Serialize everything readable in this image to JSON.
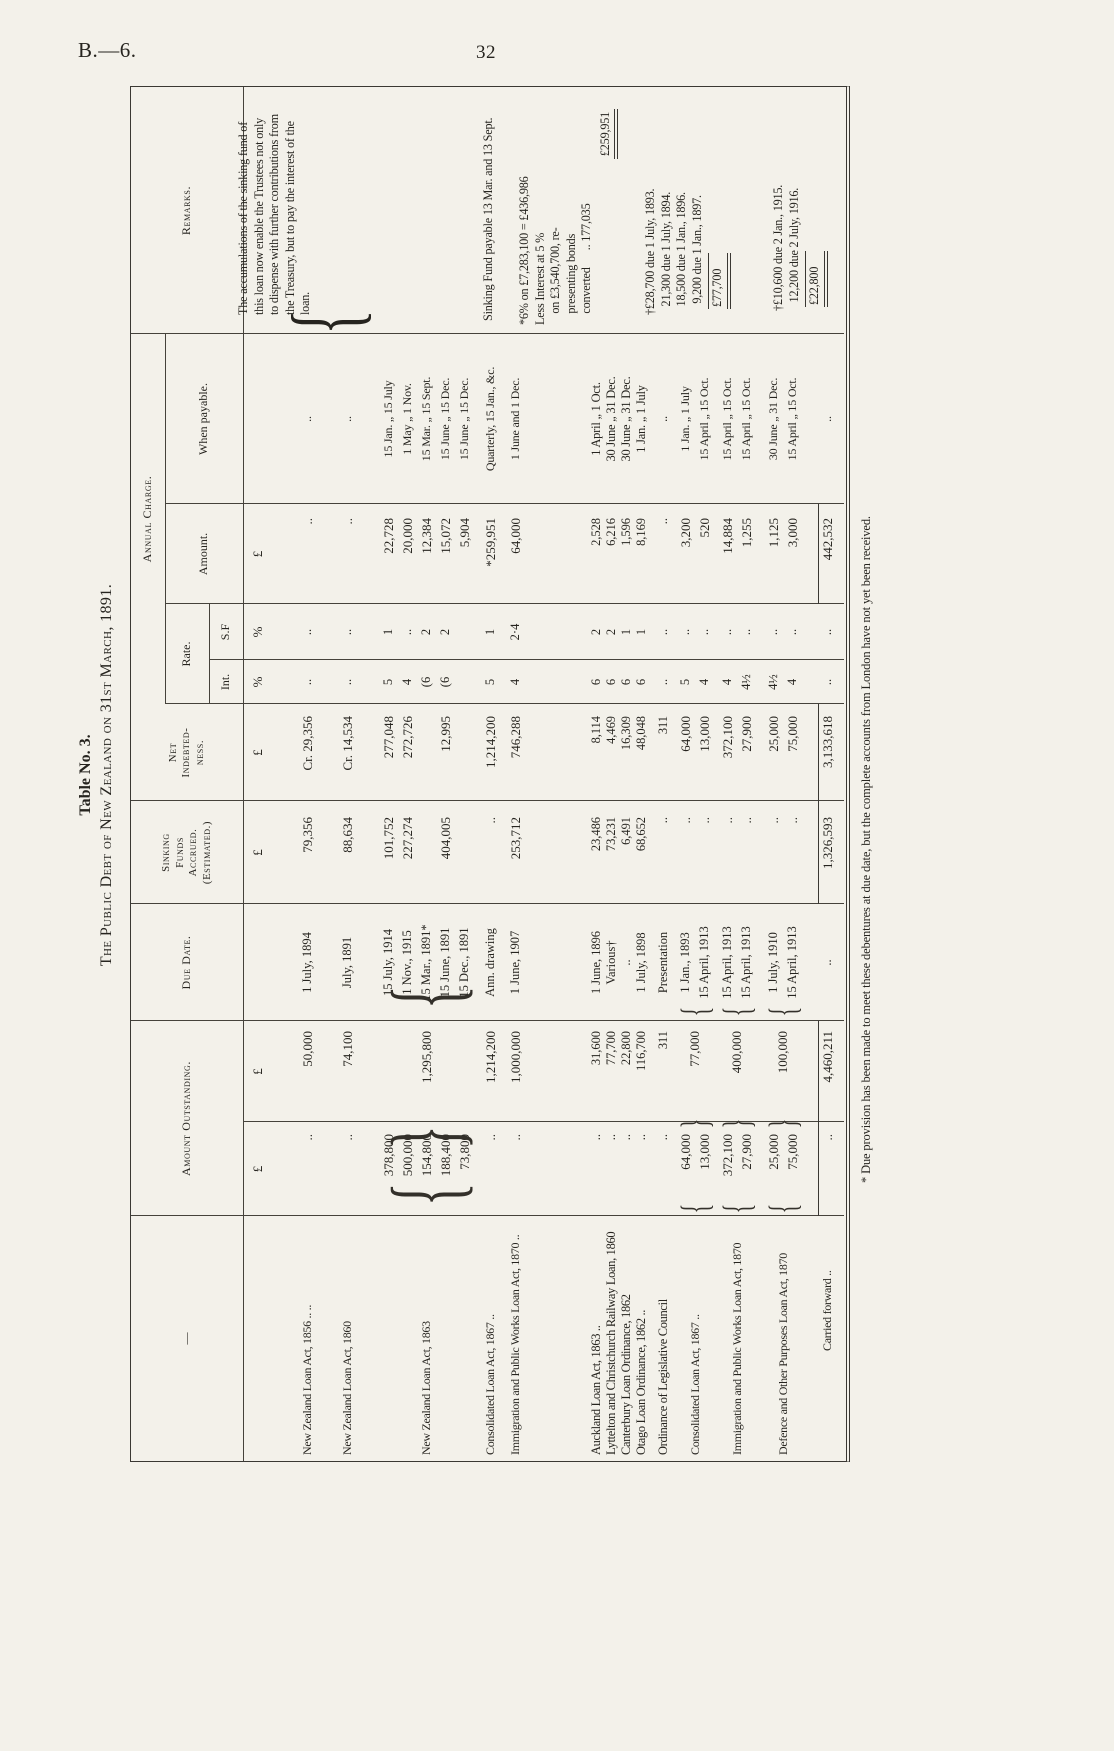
{
  "page": {
    "doc_ref": "B.—6.",
    "page_number": "32"
  },
  "title": {
    "table_no": "Table No. 3.",
    "main": "The Public Debt of New Zealand on 31st March, 1891."
  },
  "headers": {
    "first_col": "—",
    "amount_outstanding": "Amount Outstanding.",
    "due_date": "Due Date.",
    "sinking_funds": [
      "Sinking",
      "Funds",
      "Accrued.",
      "(Estimated.)"
    ],
    "net_indebtedness": [
      "Net",
      "Indebted-",
      "ness."
    ],
    "annual_charge": "Annual Charge.",
    "rate": "Rate.",
    "int": "Int.",
    "sf": "S.F",
    "amount": "Amount.",
    "when_payable": "When payable.",
    "remarks": "Remarks."
  },
  "symbols": {
    "item": "£",
    "total": "£",
    "sinking": "£",
    "net": "£",
    "int": "%",
    "sf": "%",
    "amount": "£"
  },
  "rows": [
    {
      "name": "New Zealand Loan Act, 1856  ..   ..",
      "item": "..",
      "total": "50,000",
      "due": "1 July, 1894",
      "sinking": "79,356",
      "net": "Cr. 29,356",
      "int": "..",
      "sf": "..",
      "amount": "..",
      "payable": ".."
    },
    {
      "name": "New Zealand Loan Act, 1860",
      "item": "..",
      "total": "74,100",
      "due": "July, 1891",
      "sinking": "88,634",
      "net": "Cr. 14,534",
      "int": "..",
      "sf": "..",
      "amount": "..",
      "payable": ".."
    },
    {
      "name": "New Zealand Loan Act, 1863",
      "brace": true,
      "item": [
        "378,800",
        "500,000",
        "154,800",
        "188,400",
        "73,800"
      ],
      "total": "1,295,800",
      "due": [
        "15 July, 1914",
        "1 Nov., 1915",
        "15 Mar., 1891*",
        "15 June, 1891",
        "15 Dec., 1891"
      ],
      "sinking": [
        "101,752",
        "227,274",
        "",
        "404,005",
        ""
      ],
      "net": [
        "277,048",
        "272,726",
        "",
        "12,995",
        ""
      ],
      "int": [
        "5",
        "4",
        "(6",
        "(6",
        ""
      ],
      "sf": [
        "1",
        "..",
        "2",
        "2",
        ""
      ],
      "amount": [
        "22,728",
        "20,000",
        "12,384",
        "15,072",
        "5,904"
      ],
      "payable": [
        "15 Jan. „ 15 July",
        "1 May „ 1 Nov.",
        "15 Mar. „ 15 Sept.",
        "15 June „ 15 Dec.",
        "15 June „ 15 Dec."
      ]
    },
    {
      "name": "Consolidated Loan Act, 1867 ..",
      "item": "..",
      "total": "1,214,200",
      "due": "Ann. drawing",
      "sinking": "..",
      "net": "1,214,200",
      "int": "5",
      "sf": "1",
      "amount": "*259,951",
      "payable": "Quarterly, 15 Jan., &c."
    },
    {
      "name": "Immigration and Public Works Loan Act, 1870 ..",
      "item": "..",
      "total": "1,000,000",
      "due": "1 June, 1907",
      "sinking": "253,712",
      "net": "746,288",
      "int": "4",
      "sf": "2·4",
      "amount": "64,000",
      "payable": "1 June and 1 Dec."
    },
    {
      "name": "Auckland Loan Act, 1863   ..",
      "item": "..",
      "total": "31,600",
      "due": "1 June, 1896",
      "sinking": "23,486",
      "net": "8,114",
      "int": "6",
      "sf": "2",
      "amount": "2,528",
      "payable": "1 April „ 1 Oct."
    },
    {
      "name": "Lyttelton and Christchurch Railway Loan, 1860",
      "item": "..",
      "total": "77,700",
      "due": "Various†",
      "sinking": "73,231",
      "net": "4,469",
      "int": "6",
      "sf": "2",
      "amount": "6,216",
      "payable": "30 June „ 31 Dec."
    },
    {
      "name": "Canterbury Loan Ordinance, 1862",
      "item": "..",
      "total": "22,800",
      "due": "..",
      "sinking": "6,491",
      "net": "16,309",
      "int": "6",
      "sf": "1",
      "amount": "1,596",
      "payable": "30 June „ 31 Dec."
    },
    {
      "name": "Otago Loan Ordinance, 1862  ..",
      "item": "..",
      "total": "116,700",
      "due": "1 July, 1898",
      "sinking": "68,652",
      "net": "48,048",
      "int": "6",
      "sf": "1",
      "amount": "8,169",
      "payable": "1 Jan. „ 1 July"
    },
    {
      "name": "Ordinance of Legislative Council",
      "item": "..",
      "total": "311",
      "due": "Presentation",
      "sinking": "..",
      "net": "311",
      "int": "..",
      "sf": "..",
      "amount": "..",
      "payable": ".."
    },
    {
      "name": "Consolidated Loan Act, 1867 ..",
      "brace": true,
      "item": [
        "64,000",
        "13,000"
      ],
      "total": "77,000",
      "due": [
        "1 Jan., 1893",
        "15 April, 1913"
      ],
      "sinking": [
        "..",
        ".."
      ],
      "net": [
        "64,000",
        "13,000"
      ],
      "int": [
        "5",
        "4"
      ],
      "sf": [
        "..",
        ".."
      ],
      "amount": [
        "3,200",
        "520"
      ],
      "payable": [
        "1 Jan. „ 1 July",
        "15 April „ 15 Oct."
      ]
    },
    {
      "name": "Immigration and Public Works Loan Act, 1870",
      "brace": true,
      "item": [
        "372,100",
        "27,900"
      ],
      "total": "400,000",
      "due": [
        "15 April, 1913",
        "15 April, 1913"
      ],
      "sinking": [
        "..",
        ".."
      ],
      "net": [
        "372,100",
        "27,900"
      ],
      "int": [
        "4",
        "4½"
      ],
      "sf": [
        "..",
        ".."
      ],
      "amount": [
        "14,884",
        "1,255"
      ],
      "payable": [
        "15 April „ 15 Oct.",
        "15 April „ 15 Oct."
      ]
    },
    {
      "name": "Defence and Other Purposes Loan Act, 1870",
      "brace": true,
      "item": [
        "25,000",
        "75,000"
      ],
      "total": "100,000",
      "due": [
        "1 July, 1910",
        "15 April, 1913"
      ],
      "sinking": [
        "..",
        ".."
      ],
      "net": [
        "25,000",
        "75,000"
      ],
      "int": [
        "4½",
        "4"
      ],
      "sf": [
        "..",
        ".."
      ],
      "amount": [
        "1,125",
        "3,000"
      ],
      "payable": [
        "30 June „ 31 Dec.",
        "15 April „ 15 Oct."
      ]
    },
    {
      "name": "Carried forward   ..",
      "item": "..",
      "total": "4,460,211",
      "due": "..",
      "sinking": "1,326,593",
      "net": "3,133,618",
      "int": "..",
      "sf": "..",
      "amount": "442,532",
      "payable": ".."
    }
  ],
  "remarks_blocks": [
    {
      "text": "The accumulations of the sinking fund of this loan now enable the Trustees not only to dispense with further contributions from the Treasury, but to pay the interest of the loan."
    },
    {
      "text": "Sinking Fund payable 13 Mar. and 13 Sept."
    },
    {
      "lines": [
        "*6% on £7,283,100 = £436,986",
        "Less Interest at 5 %",
        "    on £3,540,700, re-",
        "    presenting bonds",
        "    converted      .. 177,035"
      ],
      "total": "£259,951"
    },
    {
      "lines": [
        "†£28,700 due 1 July, 1893.",
        "   21,300 due 1 July, 1894.",
        "   18,500 due 1 Jan., 1896.",
        "    9,200 due 1 Jan., 1897."
      ],
      "total": "£77,700"
    },
    {
      "lines": [
        "†£10,600 due 2 Jan., 1915.",
        "   12,200 due 2 July, 1916."
      ],
      "total": "£22,800"
    }
  ],
  "footnote": "* Due provision has been made to meet these debentures at due date, but the complete accounts from London have not yet been received."
}
